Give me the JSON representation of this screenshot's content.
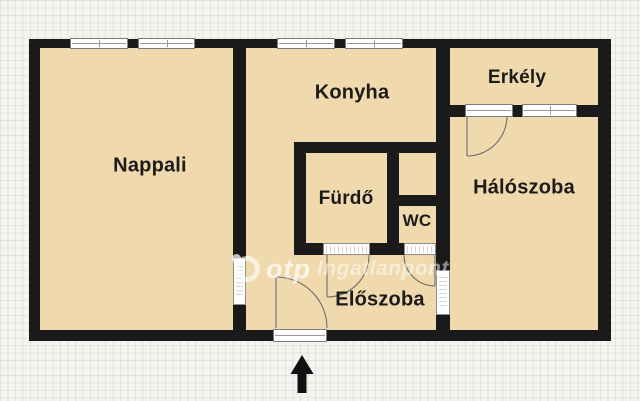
{
  "floorplan": {
    "rooms": {
      "nappali": {
        "label": "Nappali"
      },
      "konyha": {
        "label": "Konyha"
      },
      "erkely": {
        "label": "Erkély"
      },
      "haloszoba": {
        "label": "Hálószoba"
      },
      "furdo": {
        "label": "Fürdő"
      },
      "wc": {
        "label": "WC"
      },
      "eloszoba": {
        "label": "Előszoba"
      }
    },
    "watermark": {
      "brand": "otp",
      "suffix": "Ingatlanpont"
    },
    "icons": {
      "entrance_arrow": "up-arrow"
    },
    "colors": {
      "wall": "#1a1a1a",
      "floor": "#f0d9ad",
      "paper": "#f5f4f1",
      "grid": "#b9b9b6",
      "opening": "#ffffff"
    }
  }
}
